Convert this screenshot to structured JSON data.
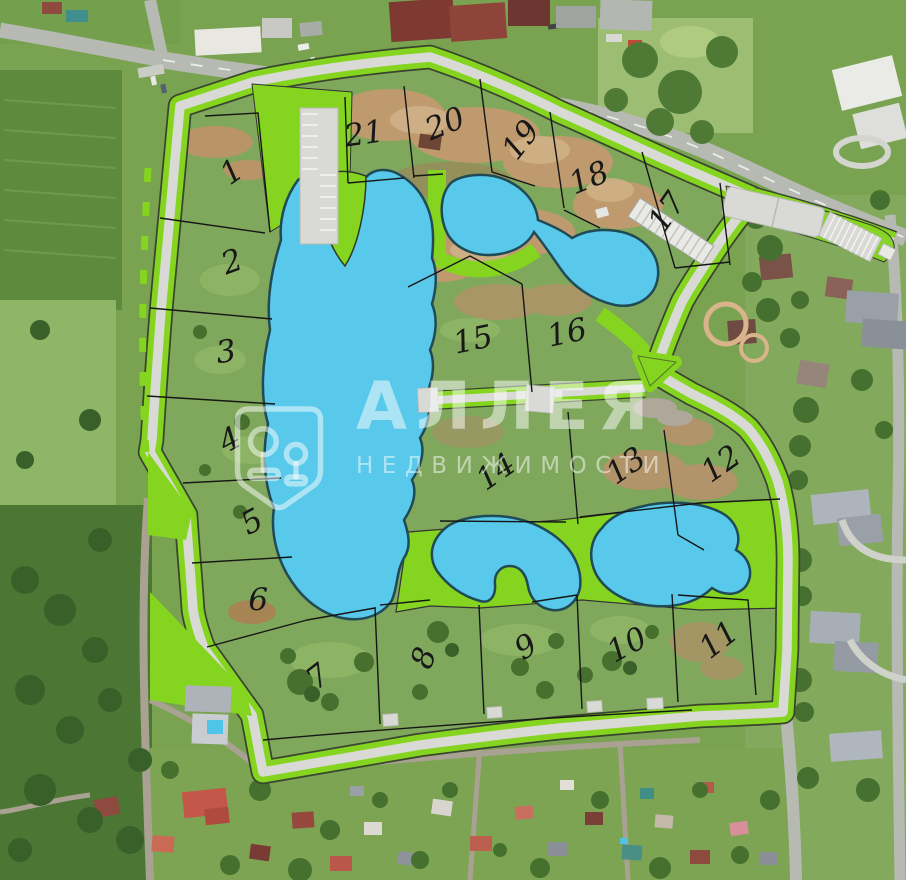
{
  "watermark": {
    "title": "АЛЛЕЯ",
    "subtitle": "НЕДВИЖИМОСТИ"
  },
  "plots": [
    {
      "number": "1",
      "x": 25.6,
      "y": 19.5,
      "rot": -35
    },
    {
      "number": "2",
      "x": 25.6,
      "y": 29.8,
      "rot": -20
    },
    {
      "number": "3",
      "x": 24.9,
      "y": 40.0,
      "rot": -8
    },
    {
      "number": "4",
      "x": 25.4,
      "y": 50.0,
      "rot": -28
    },
    {
      "number": "5",
      "x": 27.8,
      "y": 59.3,
      "rot": -28
    },
    {
      "number": "6",
      "x": 28.5,
      "y": 68.2,
      "rot": 0
    },
    {
      "number": "7",
      "x": 35.1,
      "y": 76.9,
      "rot": -38
    },
    {
      "number": "8",
      "x": 46.8,
      "y": 74.8,
      "rot": -70
    },
    {
      "number": "9",
      "x": 58.1,
      "y": 73.5,
      "rot": -32
    },
    {
      "number": "10",
      "x": 69.2,
      "y": 73.3,
      "rot": -28
    },
    {
      "number": "11",
      "x": 79.4,
      "y": 72.7,
      "rot": -38
    },
    {
      "number": "12",
      "x": 79.6,
      "y": 52.7,
      "rot": -35
    },
    {
      "number": "13",
      "x": 69.1,
      "y": 53.0,
      "rot": -35
    },
    {
      "number": "14",
      "x": 54.7,
      "y": 53.6,
      "rot": -35
    },
    {
      "number": "15",
      "x": 52.2,
      "y": 38.6,
      "rot": -12
    },
    {
      "number": "16",
      "x": 62.6,
      "y": 37.8,
      "rot": -12
    },
    {
      "number": "17",
      "x": 73.6,
      "y": 24.1,
      "rot": -55
    },
    {
      "number": "18",
      "x": 65.0,
      "y": 20.2,
      "rot": -22
    },
    {
      "number": "19",
      "x": 57.5,
      "y": 15.9,
      "rot": -52
    },
    {
      "number": "20",
      "x": 49.1,
      "y": 14.1,
      "rot": -22
    },
    {
      "number": "21",
      "x": 40.2,
      "y": 15.2,
      "rot": -8
    }
  ],
  "colors": {
    "water": "#58C9EA",
    "boundary_green": "#85D41F",
    "road_gray": "#D9DAD5",
    "plot_line": "#161616"
  }
}
